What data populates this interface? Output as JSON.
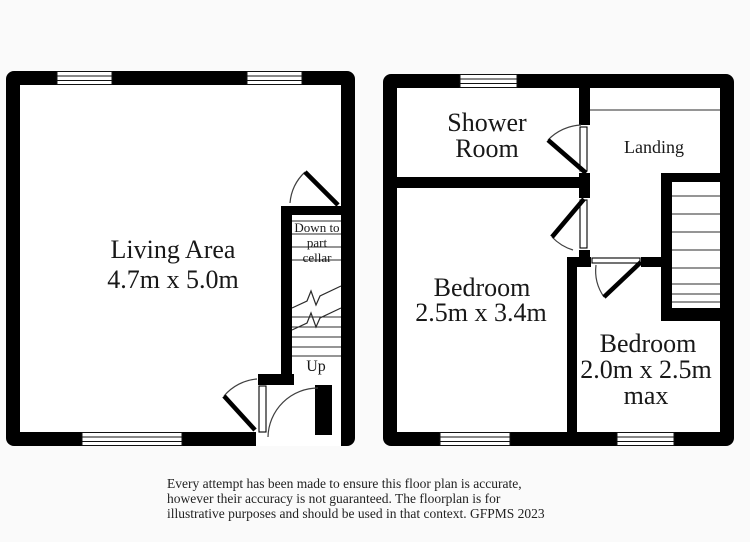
{
  "colors": {
    "wall": "#000000",
    "background": "#fafafa",
    "floor": "#ffffff",
    "text": "#181818"
  },
  "ground_floor": {
    "living_area": {
      "label": "Living Area",
      "dims": "4.7m x 5.0m"
    },
    "cellar_stairs": {
      "line1": "Down to",
      "line2": "part",
      "line3": "cellar"
    },
    "up_label": "Up"
  },
  "first_floor": {
    "shower_room": {
      "line1": "Shower",
      "line2": "Room"
    },
    "landing_label": "Landing",
    "bedroom_1": {
      "label": "Bedroom",
      "dims": "2.5m x 3.4m"
    },
    "bedroom_2": {
      "label": "Bedroom",
      "dims": "2.0m x 2.5m",
      "dims_suffix": "max"
    }
  },
  "disclaimer": {
    "line1": "Every attempt has been made to ensure this floor plan is accurate,",
    "line2": "however their accuracy is not guaranteed. The floorplan is for",
    "line3": "illustrative purposes and should be used in that context. GFPMS 2023"
  }
}
